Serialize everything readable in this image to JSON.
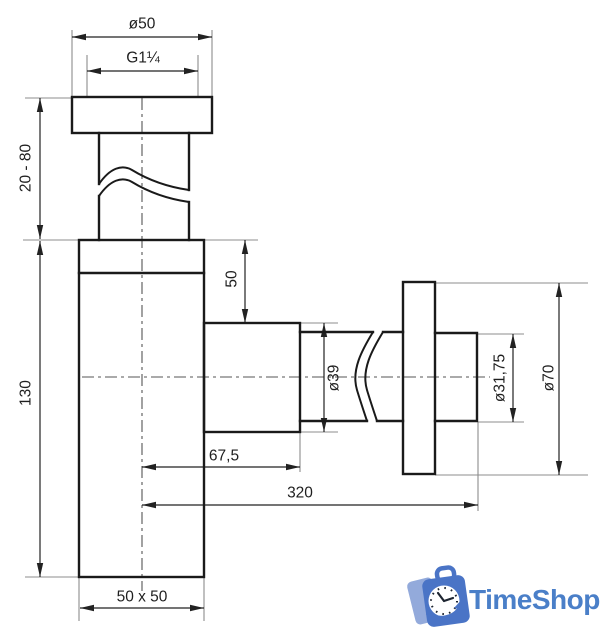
{
  "drawing": {
    "dimensions": {
      "cap_diameter": "ø50",
      "thread": "G1¼",
      "adjustable_height": "20 - 80",
      "body_height": "130",
      "outlet_top_offset": "50",
      "nut_diameter": "ø39",
      "outlet_projection": "67,5",
      "overall_length": "320",
      "pipe_diameter": "ø31,75",
      "flange_diameter": "ø70",
      "body_cross_section": "50 x 50"
    },
    "colors": {
      "outline": "#1a1a1a",
      "dimension": "#222222",
      "extension": "#8c8c8c",
      "centerline": "#555555",
      "background": "#ffffff"
    }
  },
  "logo": {
    "text": "TimeShop",
    "color_primary": "#4a74c6",
    "color_light": "#93aadb",
    "color_text": "#4a7fc8",
    "color_clock_face": "#ffffff",
    "color_clock_marks": "#1d2430"
  }
}
